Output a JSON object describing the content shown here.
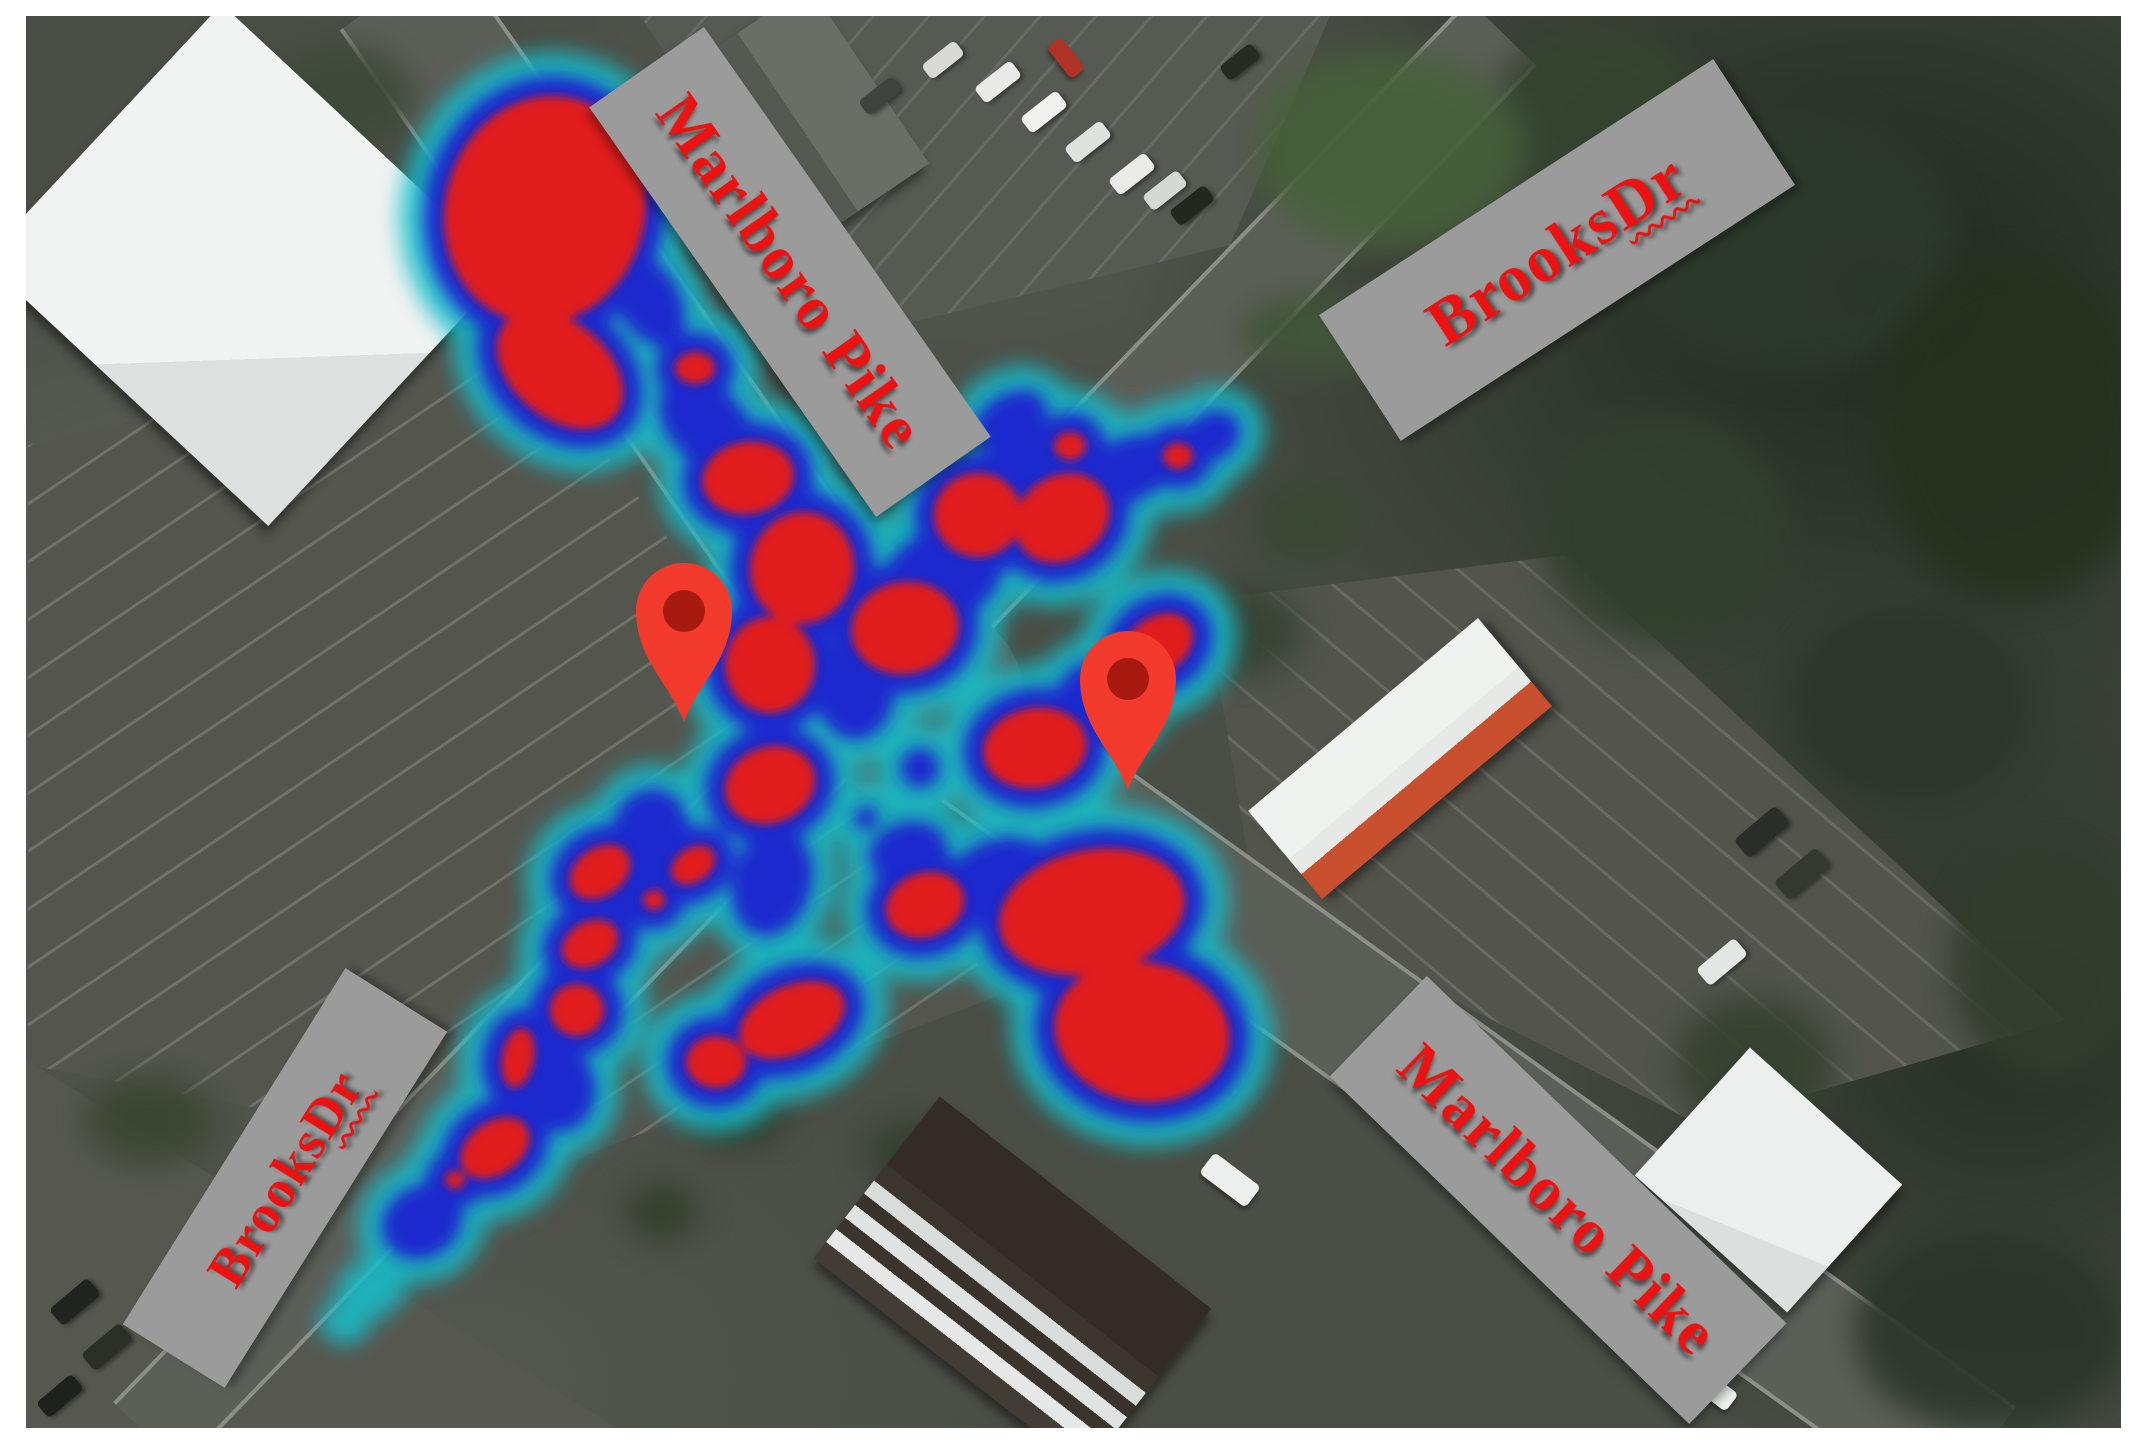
{
  "map": {
    "description": "Aerial satellite view of the Marlboro Pike and Brooks Dr intersection with a red-blue crash density heatmap overlay and two location pins",
    "colors": {
      "heat_low_cyan": "#14bdc9",
      "heat_mid_blue": "#1b24cf",
      "heat_high_red": "#e01d1d",
      "pin_body": "#f23b2c",
      "pin_core": "#a81a10",
      "label_background": "#9b9b9b",
      "label_text": "#ee1111",
      "frame": "#ffffff"
    },
    "road_labels": [
      {
        "id": "marlboro-pike-nw",
        "text": "Marlboro Pike",
        "underline_word": "",
        "cx": 790,
        "cy": 272,
        "w": 500,
        "h": 140,
        "rot": 55,
        "fs": 62
      },
      {
        "id": "brooks-dr-ne",
        "text": "Brooks Dr",
        "underline_word": "Dr",
        "cx": 1557,
        "cy": 250,
        "w": 470,
        "h": 150,
        "rot": -33,
        "fs": 66
      },
      {
        "id": "brooks-dr-sw",
        "text": "Brooks Dr",
        "underline_word": "Dr",
        "cx": 285,
        "cy": 1178,
        "w": 420,
        "h": 120,
        "rot": -58,
        "fs": 54
      },
      {
        "id": "marlboro-pike-se",
        "text": "Marlboro Pike",
        "underline_word": "",
        "cx": 1558,
        "cy": 1200,
        "w": 500,
        "h": 140,
        "rot": 44,
        "fs": 62
      }
    ],
    "pins": [
      {
        "id": "pin-west",
        "tip_x": 684,
        "tip_y": 722
      },
      {
        "id": "pin-east",
        "tip_x": 1128,
        "tip_y": 790
      }
    ],
    "heat_blobs_format": "[cx, cy, rx, ry, rotationDeg, level] level 3=red core, 2=blue, 1=cyan only",
    "heat_blobs": [
      [
        545,
        210,
        100,
        115,
        15,
        3
      ],
      [
        560,
        370,
        72,
        48,
        40,
        3
      ],
      [
        695,
        368,
        20,
        16,
        0,
        3
      ],
      [
        748,
        478,
        46,
        36,
        -10,
        3
      ],
      [
        802,
        568,
        52,
        56,
        10,
        3
      ],
      [
        770,
        665,
        45,
        48,
        0,
        3
      ],
      [
        770,
        785,
        46,
        38,
        -20,
        3
      ],
      [
        905,
        628,
        54,
        46,
        -10,
        3
      ],
      [
        978,
        515,
        44,
        42,
        0,
        3
      ],
      [
        1062,
        518,
        50,
        42,
        -35,
        3
      ],
      [
        1070,
        446,
        16,
        14,
        0,
        3
      ],
      [
        1178,
        456,
        15,
        13,
        0,
        3
      ],
      [
        1158,
        645,
        38,
        28,
        -35,
        3
      ],
      [
        1035,
        748,
        52,
        40,
        -10,
        3
      ],
      [
        1092,
        912,
        94,
        62,
        -12,
        3
      ],
      [
        1142,
        1032,
        88,
        70,
        10,
        3
      ],
      [
        925,
        905,
        40,
        32,
        -20,
        3
      ],
      [
        792,
        1020,
        56,
        34,
        -25,
        3
      ],
      [
        716,
        1062,
        30,
        26,
        0,
        3
      ],
      [
        693,
        865,
        24,
        17,
        -35,
        3
      ],
      [
        600,
        872,
        33,
        24,
        -35,
        3
      ],
      [
        654,
        900,
        11,
        10,
        0,
        3
      ],
      [
        590,
        944,
        30,
        22,
        -30,
        3
      ],
      [
        577,
        1010,
        27,
        26,
        0,
        3
      ],
      [
        518,
        1058,
        16,
        30,
        10,
        3
      ],
      [
        495,
        1148,
        38,
        26,
        -35,
        3
      ],
      [
        455,
        1180,
        10,
        9,
        0,
        3
      ],
      [
        648,
        300,
        50,
        32,
        60,
        2
      ],
      [
        706,
        424,
        55,
        38,
        45,
        2
      ],
      [
        780,
        520,
        55,
        45,
        30,
        2
      ],
      [
        855,
        690,
        40,
        50,
        0,
        2
      ],
      [
        942,
        576,
        62,
        46,
        -20,
        2
      ],
      [
        1022,
        470,
        55,
        40,
        -40,
        2
      ],
      [
        1128,
        470,
        50,
        32,
        -25,
        2
      ],
      [
        1212,
        436,
        30,
        24,
        -30,
        2
      ],
      [
        1010,
        420,
        40,
        26,
        -30,
        2
      ],
      [
        1100,
        700,
        45,
        40,
        0,
        2
      ],
      [
        920,
        768,
        20,
        20,
        0,
        2
      ],
      [
        866,
        818,
        12,
        12,
        0,
        2
      ],
      [
        908,
        852,
        40,
        30,
        -15,
        2
      ],
      [
        1002,
        880,
        55,
        42,
        -15,
        2
      ],
      [
        772,
        882,
        40,
        55,
        15,
        2
      ],
      [
        650,
        830,
        38,
        42,
        20,
        2
      ],
      [
        560,
        1090,
        36,
        42,
        0,
        2
      ],
      [
        422,
        1222,
        42,
        36,
        -30,
        2
      ],
      [
        372,
        1288,
        38,
        30,
        -30,
        1
      ],
      [
        345,
        1322,
        26,
        22,
        0,
        1
      ]
    ],
    "buildings_format": "{id,cx,cy,w,h,rot,bg}",
    "buildings": [
      {
        "id": "building-nw-white",
        "cx": 245,
        "cy": 265,
        "w": 390,
        "h": 350,
        "rot": 43,
        "bg": "linear-gradient(135deg,#f1f3f2 0 68%,#dde0de 68%)"
      },
      {
        "id": "building-top-house",
        "cx": 800,
        "cy": 120,
        "w": 215,
        "h": 165,
        "rot": 56,
        "bg": "linear-gradient(to bottom,#6b6e67 0 52%,#565951 52%)"
      },
      {
        "id": "building-restaurant",
        "cx": 1400,
        "cy": 758,
        "w": 300,
        "h": 115,
        "rot": -40,
        "bg": "linear-gradient(to bottom,#eff1ef 0 55%,#e7e9e7 55% 72%,#c8502f 72%)"
      },
      {
        "id": "building-se-strip",
        "cx": 1012,
        "cy": 1283,
        "w": 345,
        "h": 205,
        "rot": 38,
        "bg": "linear-gradient(to bottom,#332c26 0 42%,#3c352e 42% 52%,#d8dcda 52% 60%,#3a332c 60% 67%,#dfe3e1 67% 75%,#3b342d 75% 82%,#e5e8e6 82% 90%,#423c34 90%)"
      },
      {
        "id": "building-e-white",
        "cx": 1768,
        "cy": 1180,
        "w": 205,
        "h": 172,
        "rot": 42,
        "bg": "linear-gradient(160deg,#edefee 0 75%,#dcdfdd 75%)"
      }
    ],
    "vehicles_format": "[cx, cy, w, h, rotationDeg, color]",
    "vehicles": [
      [
        998,
        82,
        46,
        20,
        -38,
        "#e9e9e7"
      ],
      [
        1044,
        112,
        46,
        20,
        -38,
        "#f0f0ee"
      ],
      [
        1088,
        142,
        46,
        20,
        -38,
        "#dfe1de"
      ],
      [
        1132,
        174,
        46,
        20,
        -38,
        "#eaeae8"
      ],
      [
        943,
        60,
        42,
        18,
        -38,
        "#d9d9d5"
      ],
      [
        1066,
        58,
        40,
        18,
        52,
        "#b03226"
      ],
      [
        880,
        96,
        42,
        18,
        -38,
        "#3f453e"
      ],
      [
        1192,
        205,
        44,
        19,
        -38,
        "#22261f"
      ],
      [
        1240,
        62,
        40,
        18,
        -38,
        "#262a22"
      ],
      [
        1165,
        190,
        44,
        19,
        -38,
        "#d6d8d4"
      ],
      [
        1762,
        832,
        54,
        24,
        -40,
        "#2a2d28"
      ],
      [
        1802,
        874,
        54,
        24,
        -40,
        "#35382f"
      ],
      [
        1722,
        962,
        50,
        22,
        -40,
        "#e4e6e3"
      ],
      [
        1230,
        1180,
        58,
        26,
        37,
        "#edefed"
      ],
      [
        1712,
        1388,
        50,
        22,
        37,
        "#eef0ee"
      ],
      [
        75,
        1302,
        50,
        22,
        -40,
        "#22251f"
      ],
      [
        107,
        1347,
        50,
        22,
        -40,
        "#2c2f28"
      ],
      [
        60,
        1396,
        46,
        20,
        -40,
        "#1f221c"
      ]
    ],
    "tree_patches_format": "[cx, cy, w, h, color]",
    "tree_patches": [
      [
        1790,
        240,
        340,
        270,
        "#2c3a2b"
      ],
      [
        2015,
        430,
        270,
        340,
        "#25311f"
      ],
      [
        1665,
        530,
        250,
        230,
        "#31402e"
      ],
      [
        1600,
        110,
        210,
        170,
        "#354431"
      ],
      [
        1910,
        705,
        240,
        200,
        "#2b382a"
      ],
      [
        2045,
        965,
        190,
        230,
        "#303d2c"
      ],
      [
        1990,
        1330,
        270,
        200,
        "#2a3729"
      ],
      [
        1755,
        1065,
        160,
        140,
        "#354230"
      ],
      [
        1245,
        630,
        115,
        95,
        "#364433"
      ],
      [
        1305,
        522,
        105,
        85,
        "#3a4835"
      ],
      [
        1390,
        150,
        270,
        200,
        "#47603c"
      ],
      [
        1322,
        332,
        170,
        80,
        "#42553a"
      ],
      [
        738,
        1110,
        95,
        75,
        "#2f3d2b"
      ],
      [
        908,
        1152,
        85,
        65,
        "#34412f"
      ],
      [
        662,
        1212,
        75,
        60,
        "#31402c"
      ],
      [
        345,
        95,
        140,
        100,
        "#3c4a38"
      ],
      [
        150,
        1120,
        130,
        90,
        "#3a4633"
      ]
    ]
  }
}
